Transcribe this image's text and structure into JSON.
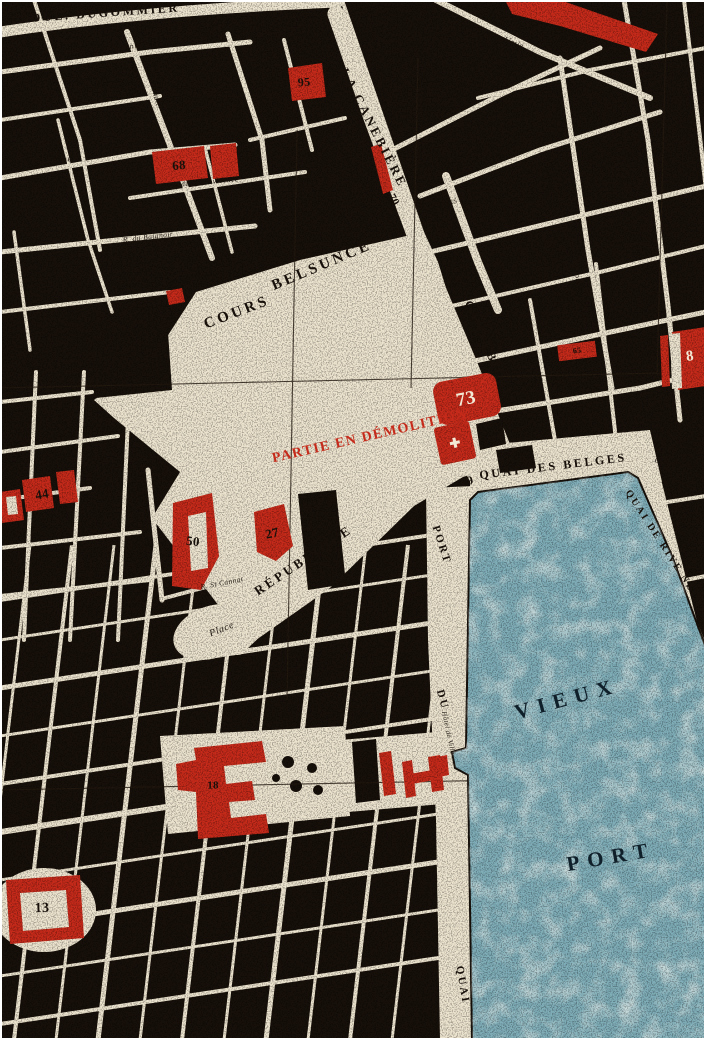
{
  "title": "Vintage street map — Vieux Port quarter, Marseille",
  "colors": {
    "paper": "#ede4cf",
    "ink": "#17100a",
    "red": "#c52a1a",
    "water": "#7fadb8",
    "water_light": "#d3e2dc",
    "grid": "#241a10"
  },
  "labels": [
    {
      "text": "BOUL. DUGOMMIER",
      "x": 100,
      "y": 13,
      "rot": -4,
      "size": 12,
      "kind": "street-major"
    },
    {
      "text": "LA CANEBIÈRE",
      "x": 374,
      "y": 128,
      "rot": 63,
      "size": 13,
      "kind": "street-major"
    },
    {
      "text": "COURS",
      "x": 237,
      "y": 313,
      "rot": -21,
      "size": 15,
      "kind": "street-major"
    },
    {
      "text": "BELSUNCE",
      "x": 322,
      "y": 266,
      "rot": -23,
      "size": 15,
      "kind": "street-major"
    },
    {
      "text": "CANNEBIÈRE",
      "x": 489,
      "y": 350,
      "rot": 67,
      "size": 12,
      "kind": "street-major"
    },
    {
      "text": "PARTIE EN DÉMOLITION",
      "x": 370,
      "y": 437,
      "rot": -13,
      "size": 14,
      "kind": "red-note"
    },
    {
      "text": "QUAI DES BELGES",
      "x": 553,
      "y": 466,
      "rot": -7,
      "size": 12,
      "kind": "street-major"
    },
    {
      "text": "COURS DU",
      "x": 676,
      "y": 464,
      "rot": 10,
      "size": 8,
      "kind": "street-minor"
    },
    {
      "text": "QUAI DE RIVE NEUVE",
      "x": 667,
      "y": 553,
      "rot": 57,
      "size": 10,
      "kind": "street-major"
    },
    {
      "text": "RÉPUBLIQUE",
      "x": 303,
      "y": 560,
      "rot": -34,
      "size": 13,
      "kind": "street-major"
    },
    {
      "text": "Place",
      "x": 222,
      "y": 630,
      "rot": -22,
      "size": 10,
      "kind": "street-minor"
    },
    {
      "text": "PORT",
      "x": 441,
      "y": 545,
      "rot": 72,
      "size": 11,
      "kind": "street-major"
    },
    {
      "text": "DU",
      "x": 442,
      "y": 700,
      "rot": 75,
      "size": 11,
      "kind": "street-major"
    },
    {
      "text": "QUAI",
      "x": 462,
      "y": 985,
      "rot": 80,
      "size": 11,
      "kind": "street-major"
    },
    {
      "text": "VIEUX",
      "x": 567,
      "y": 699,
      "rot": -15,
      "size": 21,
      "kind": "water-label"
    },
    {
      "text": "PORT",
      "x": 611,
      "y": 857,
      "rot": -10,
      "size": 21,
      "kind": "water-label"
    },
    {
      "text": "Hôtel de Ville",
      "x": 448,
      "y": 733,
      "rot": 78,
      "size": 7,
      "kind": "street-minor"
    },
    {
      "text": "COURS ST LOUIS",
      "x": 462,
      "y": 200,
      "rot": -15,
      "size": 7,
      "kind": "street-minor"
    },
    {
      "text": "Académie",
      "x": 506,
      "y": 40,
      "rot": 20,
      "size": 8.5,
      "kind": "street-minor"
    },
    {
      "text": "Dominique",
      "x": 130,
      "y": 47,
      "rot": -8,
      "size": 8,
      "kind": "street-minor"
    },
    {
      "text": "Nationale",
      "x": 154,
      "y": 90,
      "rot": 74,
      "size": 8,
      "kind": "street-minor"
    },
    {
      "text": "Longue",
      "x": 57,
      "y": 161,
      "rot": -10,
      "size": 9,
      "kind": "street-minor"
    },
    {
      "text": "R. de la Providence",
      "x": 205,
      "y": 182,
      "rot": -5,
      "size": 7.5,
      "kind": "street-minor"
    },
    {
      "text": "R. du Baignoir",
      "x": 148,
      "y": 237,
      "rot": -7,
      "size": 7.5,
      "kind": "street-minor"
    },
    {
      "text": "Vacon",
      "x": 576,
      "y": 272,
      "rot": 78,
      "size": 8,
      "kind": "street-minor"
    },
    {
      "text": "R. St Cannat",
      "x": 222,
      "y": 583,
      "rot": -11,
      "size": 7.5,
      "kind": "street-minor"
    },
    {
      "text": "Rue",
      "x": 560,
      "y": 178,
      "rot": 75,
      "size": 8,
      "kind": "street-minor"
    },
    {
      "text": "Rue",
      "x": 699,
      "y": 412,
      "rot": 80,
      "size": 8,
      "kind": "street-minor"
    }
  ],
  "landmarks": [
    {
      "label": "95",
      "x": 304,
      "y": 82,
      "rot": -5,
      "size": 12,
      "ink": "black"
    },
    {
      "label": "68",
      "x": 179,
      "y": 165,
      "rot": -5,
      "size": 13,
      "ink": "black"
    },
    {
      "label": "91",
      "x": 177,
      "y": 272,
      "rot": 72,
      "size": 13,
      "ink": "black"
    },
    {
      "label": "70",
      "x": 393,
      "y": 200,
      "rot": 60,
      "size": 11,
      "ink": "black"
    },
    {
      "label": "73",
      "x": 466,
      "y": 399,
      "rot": -11,
      "size": 19,
      "ink": "white"
    },
    {
      "label": "✚",
      "x": 455,
      "y": 443,
      "rot": -12,
      "size": 13,
      "ink": "white"
    },
    {
      "label": "29",
      "x": 467,
      "y": 481,
      "rot": -15,
      "size": 12,
      "ink": "black"
    },
    {
      "label": "65",
      "x": 577,
      "y": 351,
      "rot": -6,
      "size": 8,
      "ink": "black"
    },
    {
      "label": "8",
      "x": 690,
      "y": 357,
      "rot": -8,
      "size": 15,
      "ink": "white"
    },
    {
      "label": "44",
      "x": 42,
      "y": 494,
      "rot": -10,
      "size": 13,
      "ink": "black"
    },
    {
      "label": "50",
      "x": 193,
      "y": 541,
      "rot": 6,
      "size": 13,
      "ink": "black"
    },
    {
      "label": "27",
      "x": 272,
      "y": 533,
      "rot": -12,
      "size": 13,
      "ink": "black"
    },
    {
      "label": "13",
      "x": 42,
      "y": 909,
      "rot": -2,
      "size": 14,
      "ink": "black"
    },
    {
      "label": "18",
      "x": 213,
      "y": 786,
      "rot": 0,
      "size": 11,
      "ink": "black"
    }
  ]
}
